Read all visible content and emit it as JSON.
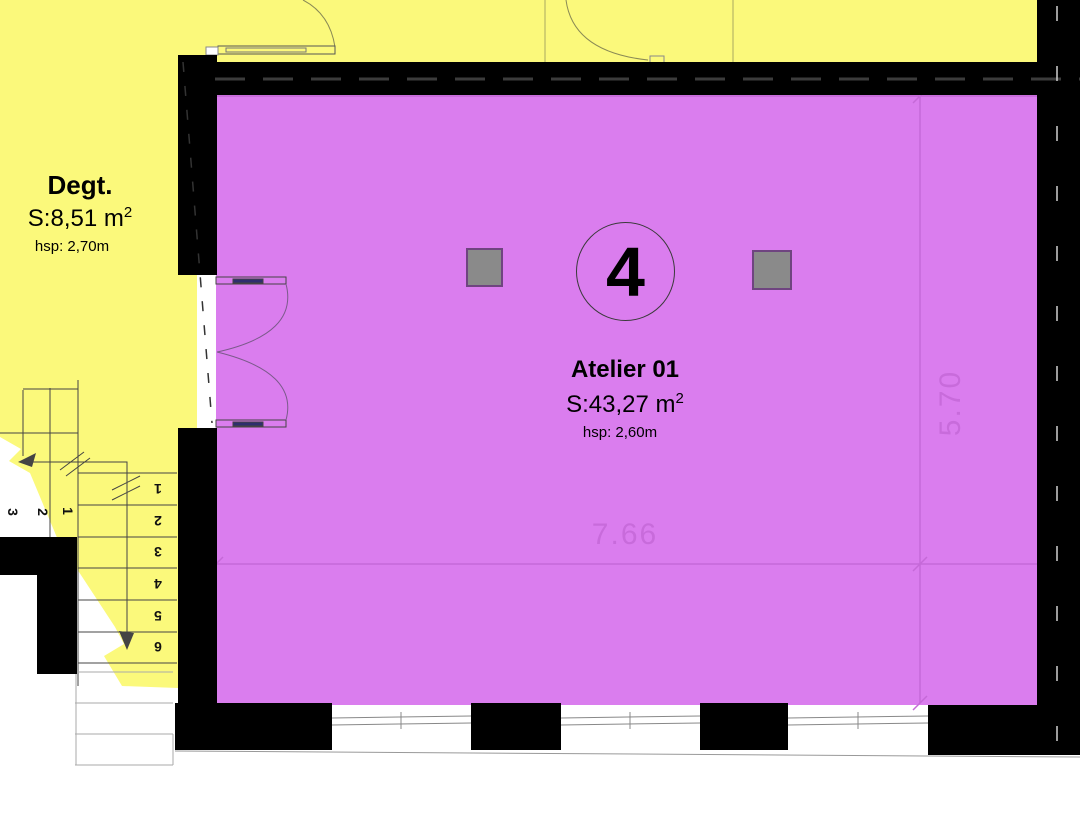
{
  "plan_title": "Floor plan - Atelier 01",
  "rooms": {
    "degt": {
      "name": "Degt.",
      "area": "S:8,51  m",
      "area_sup": "2",
      "hsp": "hsp: 2,70m"
    },
    "atelier": {
      "number": "4",
      "name": "Atelier 01",
      "area": "S:43,27  m",
      "area_sup": "2",
      "hsp": "hsp: 2,60m"
    }
  },
  "dimensions": {
    "width_m": "7.66",
    "depth_m": "5.70"
  },
  "stairs": {
    "upper_steps": [
      "3",
      "2",
      "1"
    ],
    "lower_steps": [
      "1",
      "2",
      "3",
      "4",
      "5",
      "6"
    ]
  },
  "colors": {
    "corridor_fill": "#FBF97B",
    "room_fill": "#DA7DEE",
    "dimension_color": "#C569D8",
    "column_fill": "#8A8A8A",
    "wall_color": "#000000"
  }
}
